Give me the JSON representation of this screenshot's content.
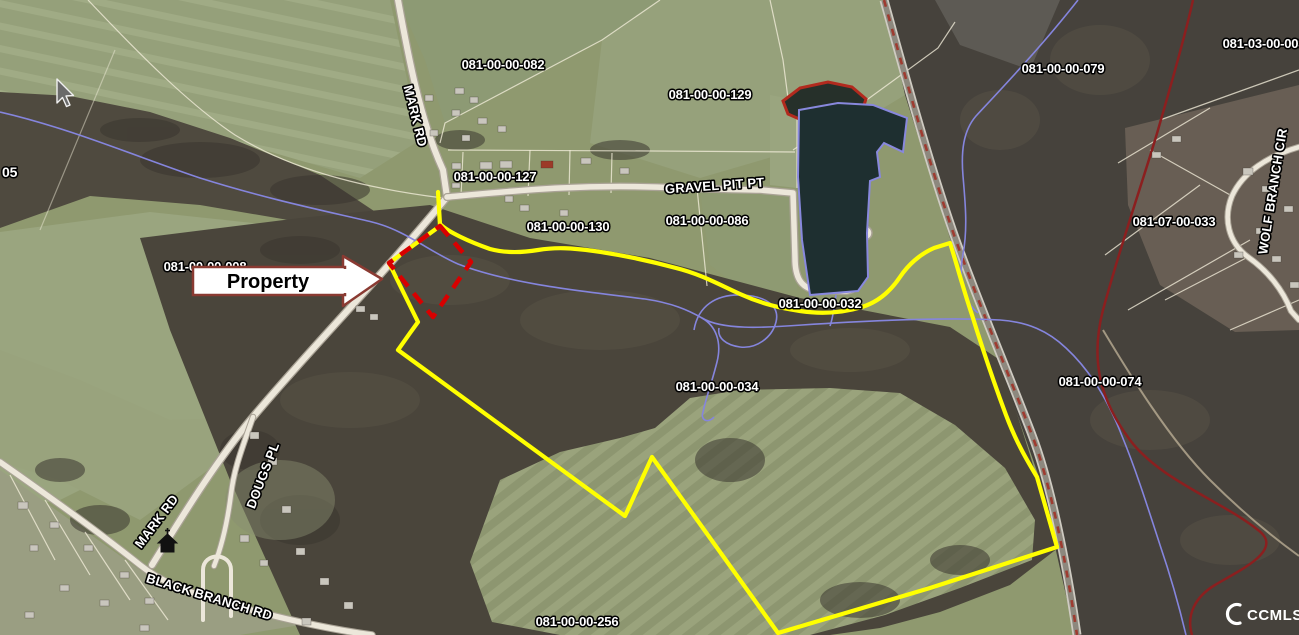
{
  "map": {
    "parcel_labels": [
      {
        "text": "081-00-00-082"
      },
      {
        "text": "081-00-00-129"
      },
      {
        "text": "081-00-00-127"
      },
      {
        "text": "081-00-00-130"
      },
      {
        "text": "081-00-00-086"
      },
      {
        "text": "081-00-00-032"
      },
      {
        "text": "081-00-00-034"
      },
      {
        "text": "081-00-00-079"
      },
      {
        "text": "081-03-00-003"
      },
      {
        "text": "081-07-00-033"
      },
      {
        "text": "081-00-00-074"
      },
      {
        "text": "081-00-00-256"
      }
    ],
    "partial_label_left": "05",
    "property_parcel_label": "081-00-00-008",
    "road_labels": [
      {
        "text": "MARK RD"
      },
      {
        "text": "GRAVEL PIT PT"
      },
      {
        "text": "MARK RD"
      },
      {
        "text": "DOUGS PL"
      },
      {
        "text": "BLACK BRANCH RD"
      },
      {
        "text": "WOLF BRANCH CIR"
      }
    ],
    "callout": {
      "text": "Property"
    },
    "watermark": {
      "text": "CCMLS"
    },
    "colors": {
      "subject_boundary": "#ffff00",
      "highlight_parcel_outline": "#d80000",
      "stream_line": "#8585dd",
      "railroad_center_dash": "#9e3b30",
      "callout_border": "#8a3a32"
    }
  }
}
